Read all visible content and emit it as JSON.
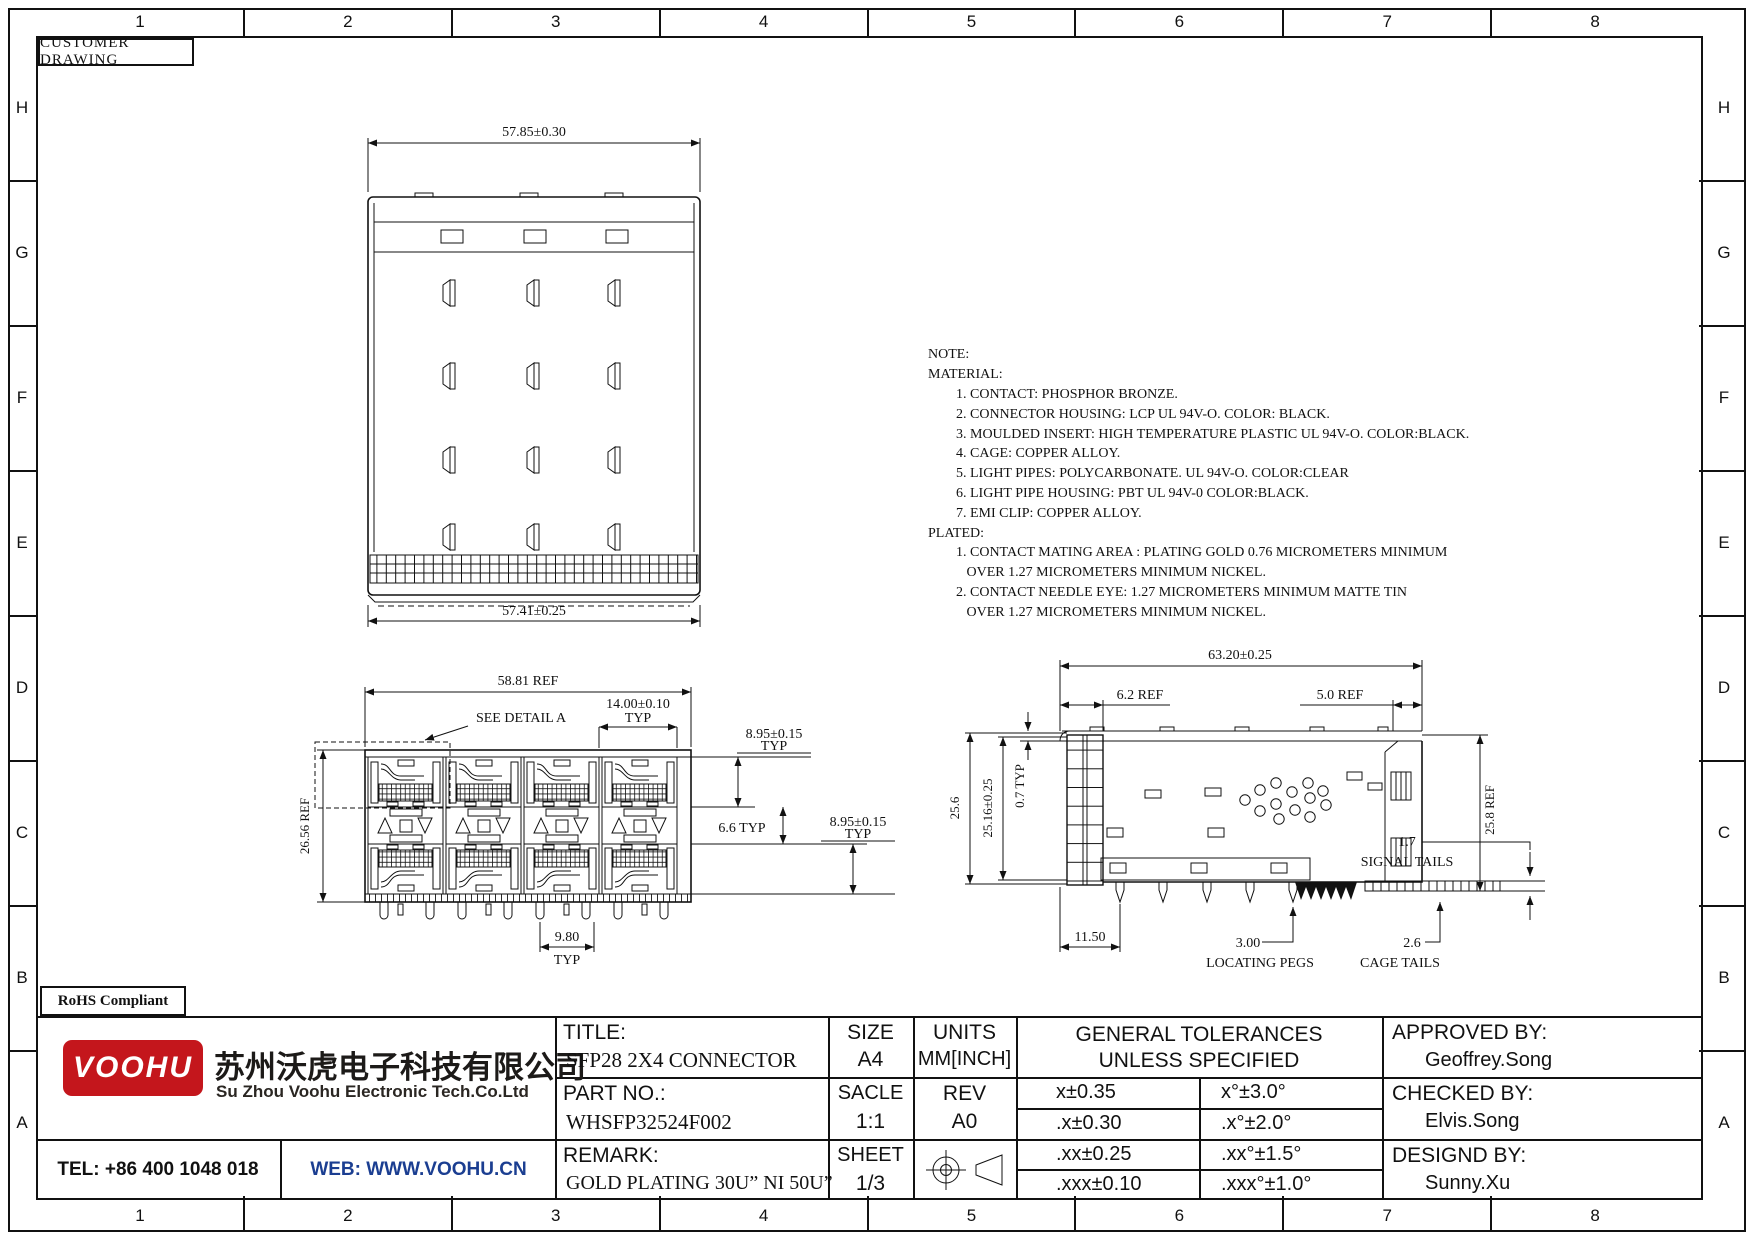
{
  "sheet": {
    "drawing_type": "CUSTOMER DRAWING",
    "rohs": "RoHS Compliant",
    "cols": [
      "1",
      "2",
      "3",
      "4",
      "5",
      "6",
      "7",
      "8"
    ],
    "rows": [
      "H",
      "G",
      "F",
      "E",
      "D",
      "C",
      "B",
      "A"
    ]
  },
  "notes": {
    "lines": [
      "NOTE:",
      "MATERIAL:",
      "        1. CONTACT: PHOSPHOR BRONZE.",
      "        2. CONNECTOR HOUSING: LCP UL 94V-O. COLOR: BLACK.",
      "        3. MOULDED INSERT: HIGH TEMPERATURE PLASTIC UL 94V-O. COLOR:BLACK.",
      "        4. CAGE: COPPER ALLOY.",
      "        5. LIGHT PIPES: POLYCARBONATE. UL 94V-O. COLOR:CLEAR",
      "        6. LIGHT PIPE HOUSING: PBT UL 94V-0 COLOR:BLACK.",
      "        7. EMI CLIP: COPPER ALLOY.",
      "PLATED:",
      "        1. CONTACT MATING AREA : PLATING GOLD 0.76 MICROMETERS MINIMUM",
      "           OVER 1.27 MICROMETERS MINIMUM NICKEL.",
      "        2. CONTACT NEEDLE EYE: 1.27 MICROMETERS MINIMUM MATTE TIN",
      "           OVER 1.27 MICROMETERS MINIMUM NICKEL."
    ]
  },
  "top_view": {
    "dim_width_top": "57.85±0.30",
    "dim_width_bottom": "57.41±0.25"
  },
  "front_view": {
    "dim_overall_width": "58.81 REF",
    "detail_callout": "SEE DETAIL A",
    "dim_port_pitch": "14.00±0.10",
    "dim_port_pitch_typ": "TYP",
    "dim_port_height_upper": "8.95±0.15",
    "dim_port_height_upper_typ": "TYP",
    "dim_row_gap": "6.6 TYP",
    "dim_port_height_lower": "8.95±0.15",
    "dim_port_height_lower_typ": "TYP",
    "dim_overall_height": "26.56 REF",
    "dim_pin_pitch": "9.80",
    "dim_pin_pitch_typ": "TYP"
  },
  "side_view": {
    "dim_overall_depth": "63.20±0.25",
    "dim_front_depth": "6.2 REF",
    "dim_rear_depth": "5.0 REF",
    "dim_height_total": "25.6",
    "dim_height_body": "25.16±0.25",
    "dim_lid": "0.7 TYP",
    "dim_height_rear": "25.8 REF",
    "dim_peg_offset": "11.50",
    "dim_peg": "3.00",
    "label_pegs": "LOCATING PEGS",
    "dim_cage_tail": "2.6",
    "label_cage_tails": "CAGE TAILS",
    "dim_signal_tail": "1.7",
    "label_signal_tails": "SIGNAL TAILS"
  },
  "title_block": {
    "title_label": "TITLE:",
    "title": "SFP28 2X4 CONNECTOR",
    "size_label": "SIZE",
    "size": "A4",
    "units_label": "UNITS",
    "units": "MM[INCH]",
    "part_label": "PART NO.:",
    "part_no": "WHSFP32524F002",
    "scale_label": "SACLE",
    "scale": "1:1",
    "rev_label": "REV",
    "rev": "A0",
    "remark_label": "REMARK:",
    "remark": "GOLD PLATING 30U”  NI 50U”",
    "sheet_label": "SHEET",
    "sheet": "1/3",
    "tolerance_title_line1": "GENERAL TOLERANCES",
    "tolerance_title_line2": "UNLESS SPECIFIED",
    "tolerances": [
      {
        "linear": "x±0.35",
        "angular": "x°±3.0°"
      },
      {
        "linear": ".x±0.30",
        "angular": ".x°±2.0°"
      },
      {
        "linear": ".xx±0.25",
        "angular": ".xx°±1.5°"
      },
      {
        "linear": ".xxx±0.10",
        "angular": ".xxx°±1.0°"
      }
    ],
    "approved_label": "APPROVED BY:",
    "approved_by": "Geoffrey.Song",
    "checked_label": "CHECKED BY:",
    "checked_by": "Elvis.Song",
    "designed_label": "DESIGND BY:",
    "designed_by": "Sunny.Xu"
  },
  "company": {
    "logo_text": "VOOHU",
    "name_cn": "苏州沃虎电子科技有限公司",
    "name_en": "Su Zhou Voohu Electronic Tech.Co.Ltd",
    "tel": "TEL: +86 400 1048 018",
    "web": "WEB: WWW.VOOHU.CN",
    "brand_red": "#c4161c",
    "web_blue": "#1b3e91"
  }
}
